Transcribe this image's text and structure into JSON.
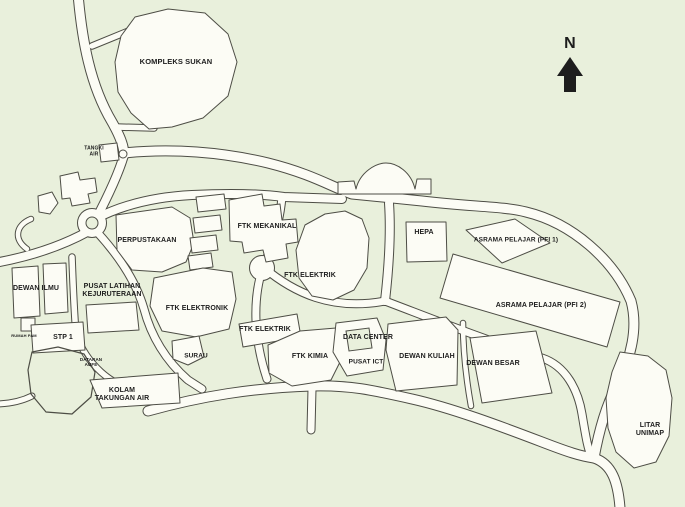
{
  "colors": {
    "background": "#e9f0dc",
    "surface": "#fcfcf5",
    "outline": "#4d4d45",
    "text": "#1d1d1d"
  },
  "compass": {
    "label": "N"
  },
  "map_labels": [
    {
      "id": "kompleks-sukan",
      "text": "KOMPLEKS SUKAN"
    },
    {
      "id": "tangki-air",
      "text": "TANGKI\nAIR"
    },
    {
      "id": "perpustakaan",
      "text": "PERPUSTAKAAN"
    },
    {
      "id": "ftk-mekanikal",
      "text": "FTK MEKANIKAL"
    },
    {
      "id": "ftk-elektrik-north",
      "text": "FTK ELEKTRIK"
    },
    {
      "id": "hepa",
      "text": "HEPA"
    },
    {
      "id": "asrama-pelajar-pfi-1",
      "text": "ASRAMA PELAJAR (PFI 1)"
    },
    {
      "id": "asrama-pelajar-pfi-2",
      "text": "ASRAMA PELAJAR (PFI 2)"
    },
    {
      "id": "dewan-ilmu",
      "text": "DEWAN ILMU"
    },
    {
      "id": "pusat-latihan-kejuruteraan",
      "text": "PUSAT LATIHAN\nKEJURUTERAAN"
    },
    {
      "id": "ftk-elektronik",
      "text": "FTK ELEKTRONIK"
    },
    {
      "id": "ftk-elektrik-south",
      "text": "FTK ELEKTRIK"
    },
    {
      "id": "surau",
      "text": "SURAU"
    },
    {
      "id": "data-center",
      "text": "DATA CENTER"
    },
    {
      "id": "ftk-kimia",
      "text": "FTK KIMIA"
    },
    {
      "id": "pusat-ict",
      "text": "PUSAT ICT"
    },
    {
      "id": "dewan-kuliah",
      "text": "DEWAN KULIAH"
    },
    {
      "id": "dewan-besar",
      "text": "DEWAN BESAR"
    },
    {
      "id": "stp-1",
      "text": "STP 1"
    },
    {
      "id": "rumah-pam",
      "text": "RUMAH PAM"
    },
    {
      "id": "dataran-aufe",
      "text": "DATARAN\nAUFE"
    },
    {
      "id": "kolam-takungan-air",
      "text": "KOLAM\nTAKUNGAN AIR"
    },
    {
      "id": "litar-unimap",
      "text": "LITAR\nUNIMAP"
    },
    {
      "id": "compass-n",
      "text": "N"
    }
  ]
}
